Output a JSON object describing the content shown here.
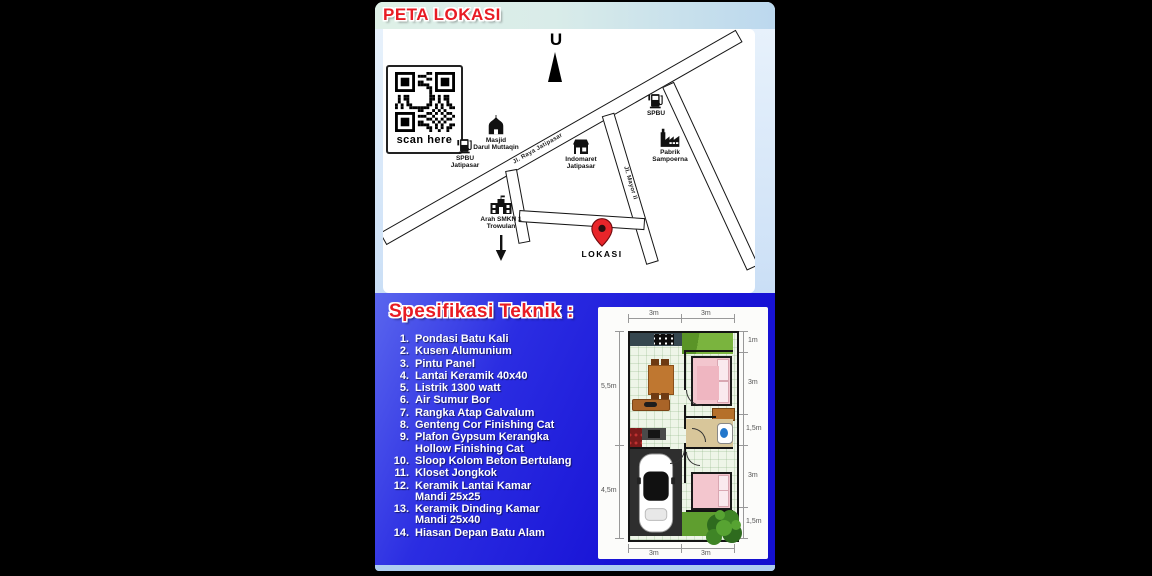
{
  "header": {
    "title": "PETA LOKASI"
  },
  "qr": {
    "caption": "scan here"
  },
  "map": {
    "north_label": "U",
    "location_label": "LOKASI",
    "roads": [
      {
        "label": "Jl. Raya Jatipasar"
      },
      {
        "label": "Jl. Mayor II"
      }
    ],
    "landmarks": [
      {
        "icon": "gas-pump-icon",
        "label": "SPBU\nJatipasar"
      },
      {
        "icon": "mosque-icon",
        "label": "Masjid\nDarul Muttaqin"
      },
      {
        "icon": "store-icon",
        "label": "Indomaret\nJatipasar"
      },
      {
        "icon": "gas-pump-icon",
        "label": "SPBU"
      },
      {
        "icon": "factory-icon",
        "label": "Pabrik\nSampoerna"
      },
      {
        "icon": "school-icon",
        "label": "Arah SMKN 1\nTrowulan"
      }
    ]
  },
  "specs": {
    "heading": "Spesifikasi Teknik :",
    "items": [
      {
        "num": "1.",
        "text": "Pondasi Batu Kali"
      },
      {
        "num": "2.",
        "text": "Kusen Alumunium"
      },
      {
        "num": "3.",
        "text": "Pintu Panel"
      },
      {
        "num": "4.",
        "text": "Lantai Keramik 40x40"
      },
      {
        "num": "5.",
        "text": "Listrik 1300 watt"
      },
      {
        "num": "6.",
        "text": "Air Sumur Bor"
      },
      {
        "num": "7.",
        "text": "Rangka Atap Galvalum"
      },
      {
        "num": "8.",
        "text": "Genteng Cor Finishing Cat"
      },
      {
        "num": "9.",
        "text": "Plafon Gypsum Kerangka\nHollow Finishing Cat"
      },
      {
        "num": "10.",
        "text": "Sloop Kolom Beton Bertulang"
      },
      {
        "num": "11.",
        "text": "Kloset Jongkok"
      },
      {
        "num": "12.",
        "text": "Keramik Lantai Kamar\nMandi 25x25"
      },
      {
        "num": "13.",
        "text": "Keramik Dinding Kamar\nMandi 25x40"
      },
      {
        "num": "14.",
        "text": "Hiasan Depan Batu Alam"
      }
    ]
  },
  "floorplan": {
    "dims": {
      "top": [
        "3m",
        "3m"
      ],
      "left": [
        "5,5m",
        "4,5m"
      ],
      "right": [
        "1m",
        "3m",
        "1,5m",
        "3m",
        "1,5m"
      ],
      "bottom": [
        "3m",
        "3m"
      ]
    }
  },
  "colors": {
    "accent_red": "#e81c24",
    "panel_blue": "#1813d6",
    "frame_light": "#cfe2f7",
    "pin_red": "#e8252a"
  }
}
